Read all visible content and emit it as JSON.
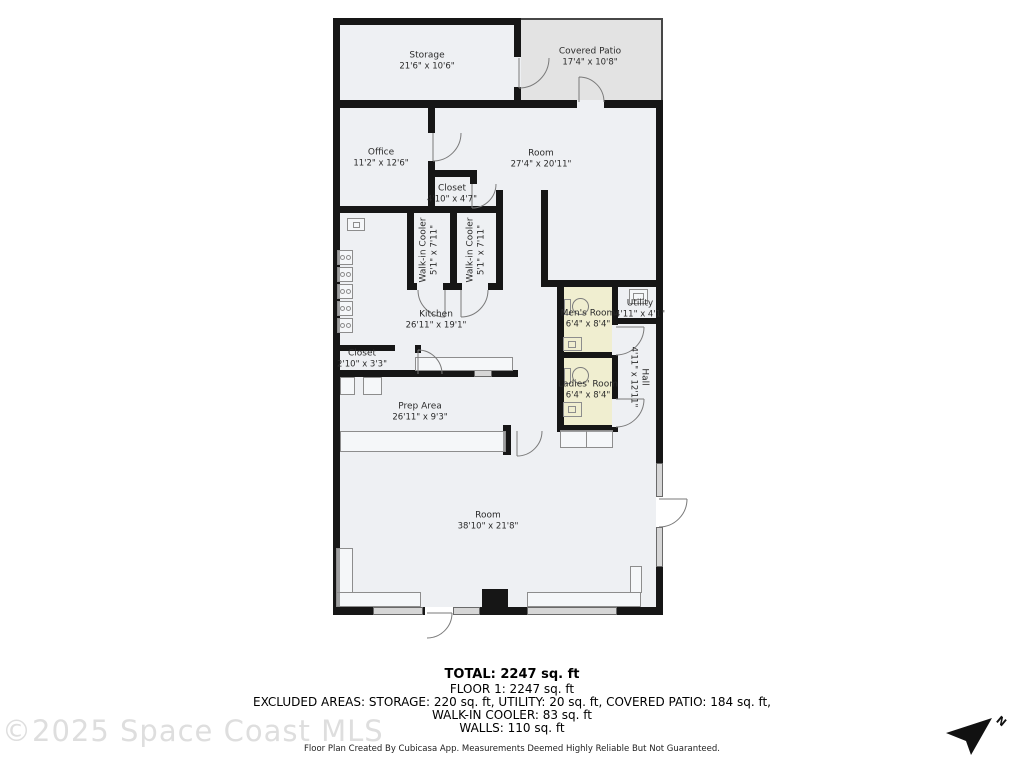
{
  "rooms": {
    "storage": {
      "name": "Storage",
      "dims": "21'6\" x 10'6\""
    },
    "covered_patio": {
      "name": "Covered Patio",
      "dims": "17'4\" x 10'8\""
    },
    "office": {
      "name": "Office",
      "dims": "11'2\" x 12'6\""
    },
    "room_upper": {
      "name": "Room",
      "dims": "27'4\" x 20'11\""
    },
    "closet_upper": {
      "name": "Closet",
      "dims": "4'10\" x 4'7\""
    },
    "cooler_left": {
      "name": "Walk-in Cooler",
      "dims": "5'1\" x 7'11\""
    },
    "cooler_right": {
      "name": "Walk-in Cooler",
      "dims": "5'1\" x 7'11\""
    },
    "kitchen": {
      "name": "Kitchen",
      "dims": "26'11\" x 19'1\""
    },
    "mens_room": {
      "name": "Men's Room",
      "dims": "6'4\" x 8'4\""
    },
    "utility": {
      "name": "Utility",
      "dims": "4'11\" x 4'1\""
    },
    "hall": {
      "name": "Hall",
      "dims": "4'11\" x 12'11\""
    },
    "closet_lower": {
      "name": "Closet",
      "dims": "2'10\" x 3'3\""
    },
    "prep_area": {
      "name": "Prep Area",
      "dims": "26'11\" x 9'3\""
    },
    "room_lower": {
      "name": "Room",
      "dims": "38'10\" x 21'8\""
    }
  },
  "summary": {
    "total": "TOTAL: 2247 sq. ft",
    "floor1": "FLOOR 1: 2247 sq. ft",
    "excluded_line1": "EXCLUDED AREAS: STORAGE: 220 sq. ft, UTILITY: 20 sq. ft, COVERED PATIO: 184 sq. ft,",
    "excluded_line2": "WALK-IN COOLER: 83 sq. ft",
    "walls": "WALLS: 110 sq. ft",
    "disclaimer": "Floor Plan Created By Cubicasa App. Measurements Deemed Highly Reliable But Not Guaranteed."
  },
  "watermark": "©2025 Space Coast MLS",
  "compass": {
    "label": "N"
  },
  "colors": {
    "wall": "#161616",
    "floor_fill": "#eef0f3",
    "patio_fill": "#e3e3e3",
    "bathroom_fill": "#f0eed0"
  }
}
